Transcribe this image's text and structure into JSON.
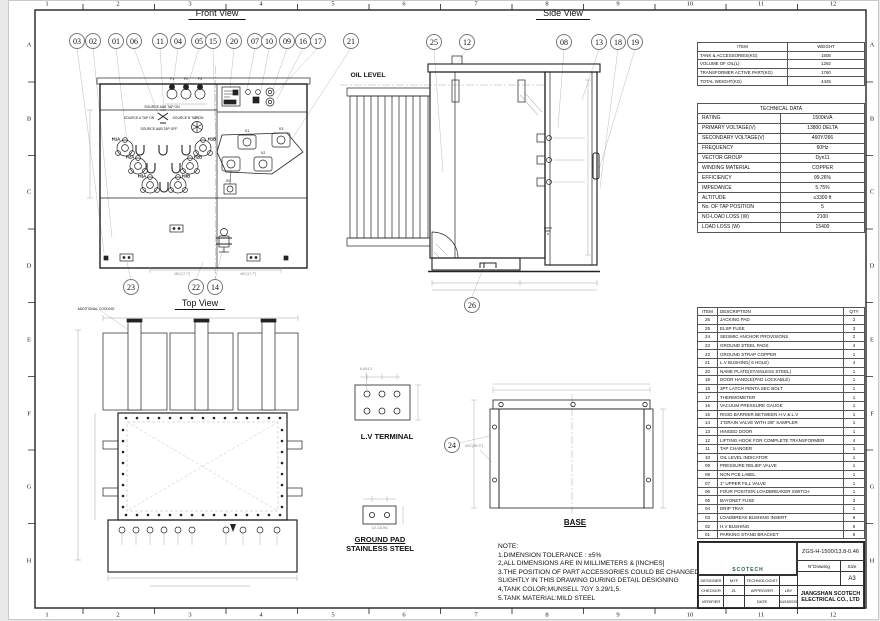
{
  "sheet": {
    "cols": [
      "1",
      "2",
      "3",
      "4",
      "5",
      "6",
      "7",
      "8",
      "9",
      "10",
      "11",
      "12"
    ],
    "rows": [
      "A",
      "B",
      "C",
      "D",
      "E",
      "F",
      "G",
      "H"
    ]
  },
  "views": {
    "front": {
      "title": "Front View",
      "fuses": [
        "F1",
        "F2",
        "F3"
      ],
      "hv": {
        "src_ab_on": "SOURCE A&B TAP ON",
        "src_a": "SOURCE A TAP ON",
        "src_b": "SOURCE B TAP ON",
        "src_ab_off": "SOURCE A&B TAP OFF",
        "x0_top": "X0",
        "h1a": "H1A",
        "h1b": "H1B",
        "h2a": "H2A",
        "h2b": "H2B",
        "h3a": "H3A",
        "h3b": "H3B"
      },
      "lv": {
        "x1": "X1",
        "x2": "X2",
        "x3": "X3",
        "x0": "X0"
      },
      "dim_left": "450 [17.7\"]",
      "dim_right": "450 [17.7\"]"
    },
    "side": {
      "title": "Side View",
      "oil_level": "OIL LEVEL"
    },
    "top": {
      "title": "Top View",
      "additional_cooling": "ADDITIONAL COOLING"
    },
    "lv_terminal": {
      "label": "L.V TERMINAL",
      "dim": "6-Ø14.3"
    },
    "ground_pad": {
      "label1": "GROUND PAD",
      "label2": "STAINLESS STEEL",
      "dim": "1/2-13UNC"
    },
    "base": {
      "label": "BASE",
      "dim": "Ø22 [Ø0.9\"]"
    }
  },
  "callouts": {
    "front_top": [
      "03",
      "02",
      "01",
      "06",
      "11",
      "04",
      "05",
      "15",
      "20",
      "07",
      "10",
      "09",
      "16",
      "17",
      "21"
    ],
    "front_bottom": [
      "23",
      "22",
      "14"
    ],
    "side": [
      "25",
      "12",
      "08",
      "13",
      "18",
      "19"
    ],
    "side_base": "26",
    "base_detail": "24"
  },
  "weight_table": {
    "headers": [
      "ITEM",
      "WEIGHT"
    ],
    "rows": [
      [
        "TANK & ACCESSORIES(KG)",
        "1505"
      ],
      [
        "VOLUME OF OIL(L)",
        "1292"
      ],
      [
        "TRANSFORMER ACTIVE PART(KG)",
        "1760"
      ],
      [
        "TOTAL WEIGHT(KG)",
        "4425"
      ]
    ]
  },
  "technical_table": {
    "title": "TECHNICAL DATA",
    "rows": [
      [
        "RATING",
        "1500kVA"
      ],
      [
        "PRIMARY VOLTAGE(V)",
        "13800 DELTA"
      ],
      [
        "SECONDARY VOLTAGE(V)",
        "460Y/266"
      ],
      [
        "FREQUENCY",
        "60Hz"
      ],
      [
        "VECTOR  GROUP",
        "Dyn11"
      ],
      [
        "WINDING MATERIAL",
        "COPPER"
      ],
      [
        "EFFICIENCY",
        "99.26%"
      ],
      [
        "IMPEDANCE",
        "5.75%"
      ],
      [
        "ALTITUDE",
        "≤3300 ft"
      ],
      [
        "No. OF TAP POSITION",
        "5"
      ],
      [
        "NO-LOAD LOSS (W)",
        "2100"
      ],
      [
        "LOAD LOSS (W)",
        "15400"
      ]
    ]
  },
  "parts_table": {
    "headers": [
      "ITEM",
      "DESCRIPTION",
      "QTY"
    ],
    "rows": [
      [
        "26",
        "JACKING PAD",
        "2"
      ],
      [
        "25",
        "ELSP FUSE",
        "3"
      ],
      [
        "24",
        "SEISMIC ANCHOR PROVISIONS",
        "2"
      ],
      [
        "23",
        "GROUND STEEL PADS",
        "4"
      ],
      [
        "22",
        "GROUND STRAP COPPER",
        "1"
      ],
      [
        "21",
        "L.V BUSHING( 6 HOLE)",
        "4"
      ],
      [
        "20",
        "NAME PLATE(STAINLESS STEEL)",
        "1"
      ],
      [
        "19",
        "DOOR HANDLE(PAD LOCKABLE)",
        "1"
      ],
      [
        "18",
        "3PT LATCH PENTA SEC BOLT",
        "1"
      ],
      [
        "17",
        "THERMOMETER",
        "1"
      ],
      [
        "16",
        "VACUUM PRESSURE GAUGE",
        "1"
      ],
      [
        "15",
        "RIGID BARRIER BETWEEN H.V & L.V",
        "1"
      ],
      [
        "14",
        "1\"DRAIN VALVE WITH 3/8\" SAMPLER",
        "1"
      ],
      [
        "13",
        "HINGED DOOR",
        "1"
      ],
      [
        "12",
        "LIFTING HOOK FOR COMPLETE TRANSFORMER",
        "4"
      ],
      [
        "11",
        "TAP CHANGER",
        "1"
      ],
      [
        "10",
        "OIL LEVEL INDICATOR",
        "1"
      ],
      [
        "09",
        "PRESSURE RELIEF VALVE",
        "1"
      ],
      [
        "08",
        "NON PCB LABEL",
        "1"
      ],
      [
        "07",
        "1\" UPPER FILL VALVE",
        "1"
      ],
      [
        "06",
        "FOUR POSITION LOADBREAKER SWITCH",
        "1"
      ],
      [
        "05",
        "BAYONET FUSE",
        "3"
      ],
      [
        "04",
        "DRIP TRAY",
        "1"
      ],
      [
        "03",
        "LOADBREAK BUSHING INSERT",
        "6"
      ],
      [
        "02",
        "H.V BUSHING",
        "6"
      ],
      [
        "01",
        "PARKING STAND BRACKET",
        "6"
      ]
    ]
  },
  "notes": {
    "title": "NOTE:",
    "lines": [
      "1.DIMENSION TOLERANCE : ±5%",
      "2,ALL DIMENSIONS ARE IN MILLIMETERS & [INCHES]",
      "3.THE POSITION OF PART ACCESSORIES COULD BE CHANGED",
      "SLIGHTLY IN THIS DRAWING DURING DETAIL DESIGNING",
      "4,TANK COLOR;MUNSELL 7GY 3.29/1,5.",
      "5.TANK MATERIAL:MILD STEEL"
    ]
  },
  "title_block": {
    "logo_text": "SCOTECH",
    "drawing_code": "ZGS-H-1500/13.8-0.46",
    "n_drawing_label": "N°Drawing",
    "size_label": "Size",
    "size_value": "A3",
    "designer_label": "DESIGNER",
    "designer": "MYF",
    "technologist_label": "TECHNOLOGIST",
    "technologist": "",
    "checker_label": "CHECKER",
    "checker": "ZL",
    "approver_label": "APPROVER",
    "approver": "LBY",
    "verifier_label": "VERIFIER",
    "verifier": "",
    "date_label": "DATE",
    "date": "04/15/2025",
    "company1": "JIANGSHAN SCOTECH",
    "company2": "ELECTRICAL CO., LTD",
    "accent_green": "#2e9e4f",
    "accent_blue": "#1f6fb4"
  }
}
